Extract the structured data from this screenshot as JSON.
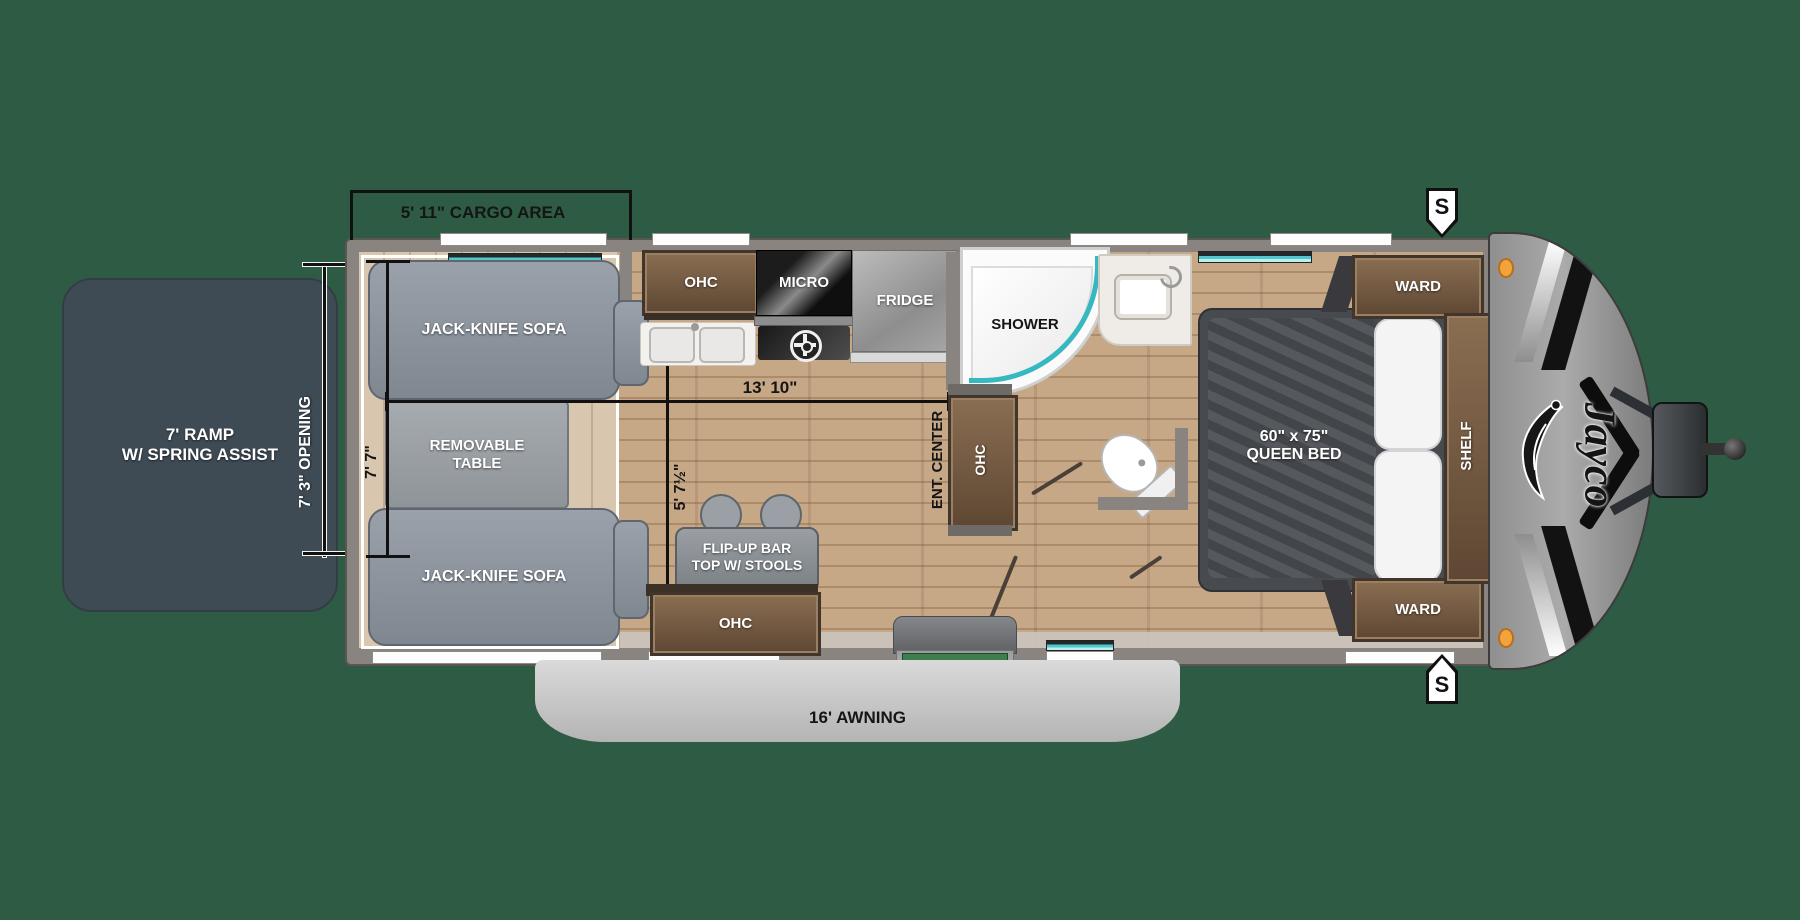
{
  "brand": {
    "logo_text": "Jayco"
  },
  "exterior": {
    "ramp_line1": "7' RAMP",
    "ramp_line2": "W/ SPRING ASSIST",
    "awning_label": "16' AWNING",
    "speaker_top": "S",
    "speaker_bottom": "S"
  },
  "dimensions": {
    "cargo_area": "5' 11\" CARGO AREA",
    "ramp_opening": "7' 3\" OPENING",
    "garage_width": "7' 7\"",
    "main_length": "13' 10\"",
    "kitchen_wall": "5' 7½\""
  },
  "garage": {
    "sofa_top": "JACK-KNIFE SOFA",
    "sofa_bottom": "JACK-KNIFE SOFA",
    "table_line1": "REMOVABLE",
    "table_line2": "TABLE"
  },
  "kitchen": {
    "ohc": "OHC",
    "micro": "MICRO",
    "fridge": "FRIDGE",
    "bar_line1": "FLIP-UP BAR",
    "bar_line2": "TOP W/ STOOLS",
    "ohc_bottom": "OHC"
  },
  "bath": {
    "shower": "SHOWER",
    "ent_center": "ENT. CENTER",
    "ohc_vertical": "OHC"
  },
  "bedroom": {
    "bed_line1": "60\" x 75\"",
    "bed_line2": "QUEEN BED",
    "ward_top": "WARD",
    "ward_bottom": "WARD",
    "shelf": "SHELF"
  },
  "colors": {
    "background": "#2d5b43",
    "ramp": "#3e4a54",
    "wall": "#8a8480",
    "floor": "#c6a887",
    "cargo_floor": "#d8c6ae",
    "wood_cabinet": "#7a6149",
    "teal_accent": "#4fc8cd",
    "awning": "#cccccc",
    "step_mat_green": "#3e7d4e",
    "marker_orange": "#f2a33c"
  }
}
